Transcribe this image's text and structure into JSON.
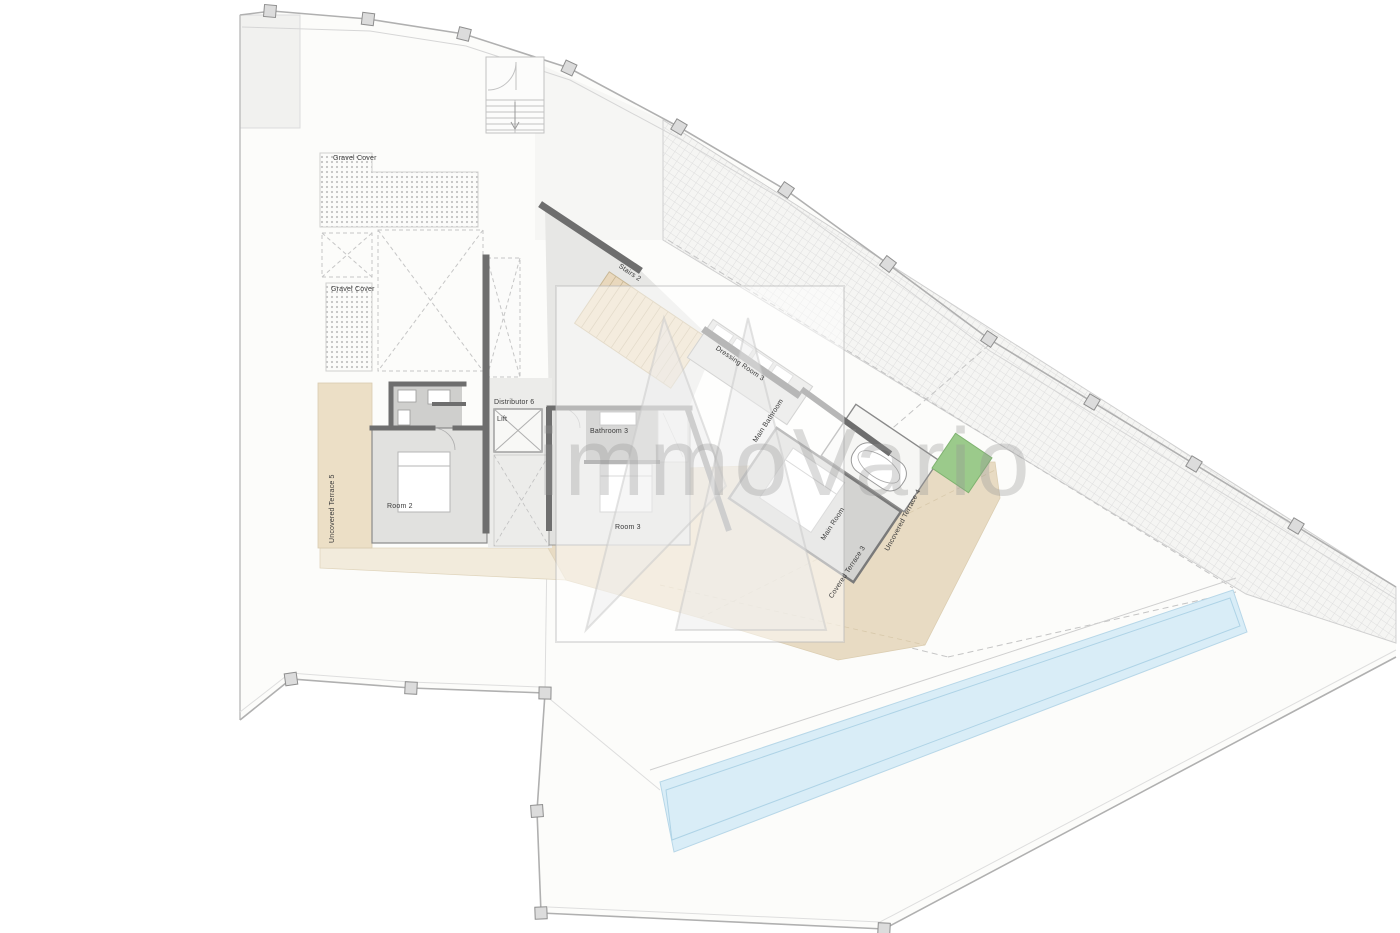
{
  "page": {
    "background": "#ffffff",
    "type": "architectural floor plan"
  },
  "watermark": {
    "text": "immoVario",
    "logo": "mountain-monogram"
  },
  "plan": {
    "rooms": [
      {
        "id": "gravel-cover-top",
        "label": "Gravel Cover"
      },
      {
        "id": "gravel-cover-left",
        "label": "Gravel Cover"
      },
      {
        "id": "stairs-2",
        "label": "Stairs 2"
      },
      {
        "id": "distributor-6",
        "label": "Distributor 6"
      },
      {
        "id": "lift",
        "label": "Lift"
      },
      {
        "id": "bathroom-3",
        "label": "Bathroom 3"
      },
      {
        "id": "room-2",
        "label": "Room 2"
      },
      {
        "id": "room-3",
        "label": "Room 3"
      },
      {
        "id": "dressing-room-3",
        "label": "Dressing Room 3"
      },
      {
        "id": "main-bathroom",
        "label": "Main Bathroom"
      },
      {
        "id": "main-room",
        "label": "Main Room"
      },
      {
        "id": "uncovered-terrace-5",
        "label": "Uncovered Terrace 5"
      },
      {
        "id": "uncovered-terrace-4",
        "label": "Uncovered Terrace 4"
      },
      {
        "id": "covered-terrace-3",
        "label": "Covered Terrace 3"
      }
    ],
    "colors": {
      "terrace": "#e8dbc3",
      "room_floor": "#e1e1df",
      "bathroom_floor": "#aeaeac",
      "wall": "#6e6e6e",
      "pool": "#d9edf7",
      "planter": "#9bca8b",
      "boundary": "#b5b5b5"
    }
  }
}
